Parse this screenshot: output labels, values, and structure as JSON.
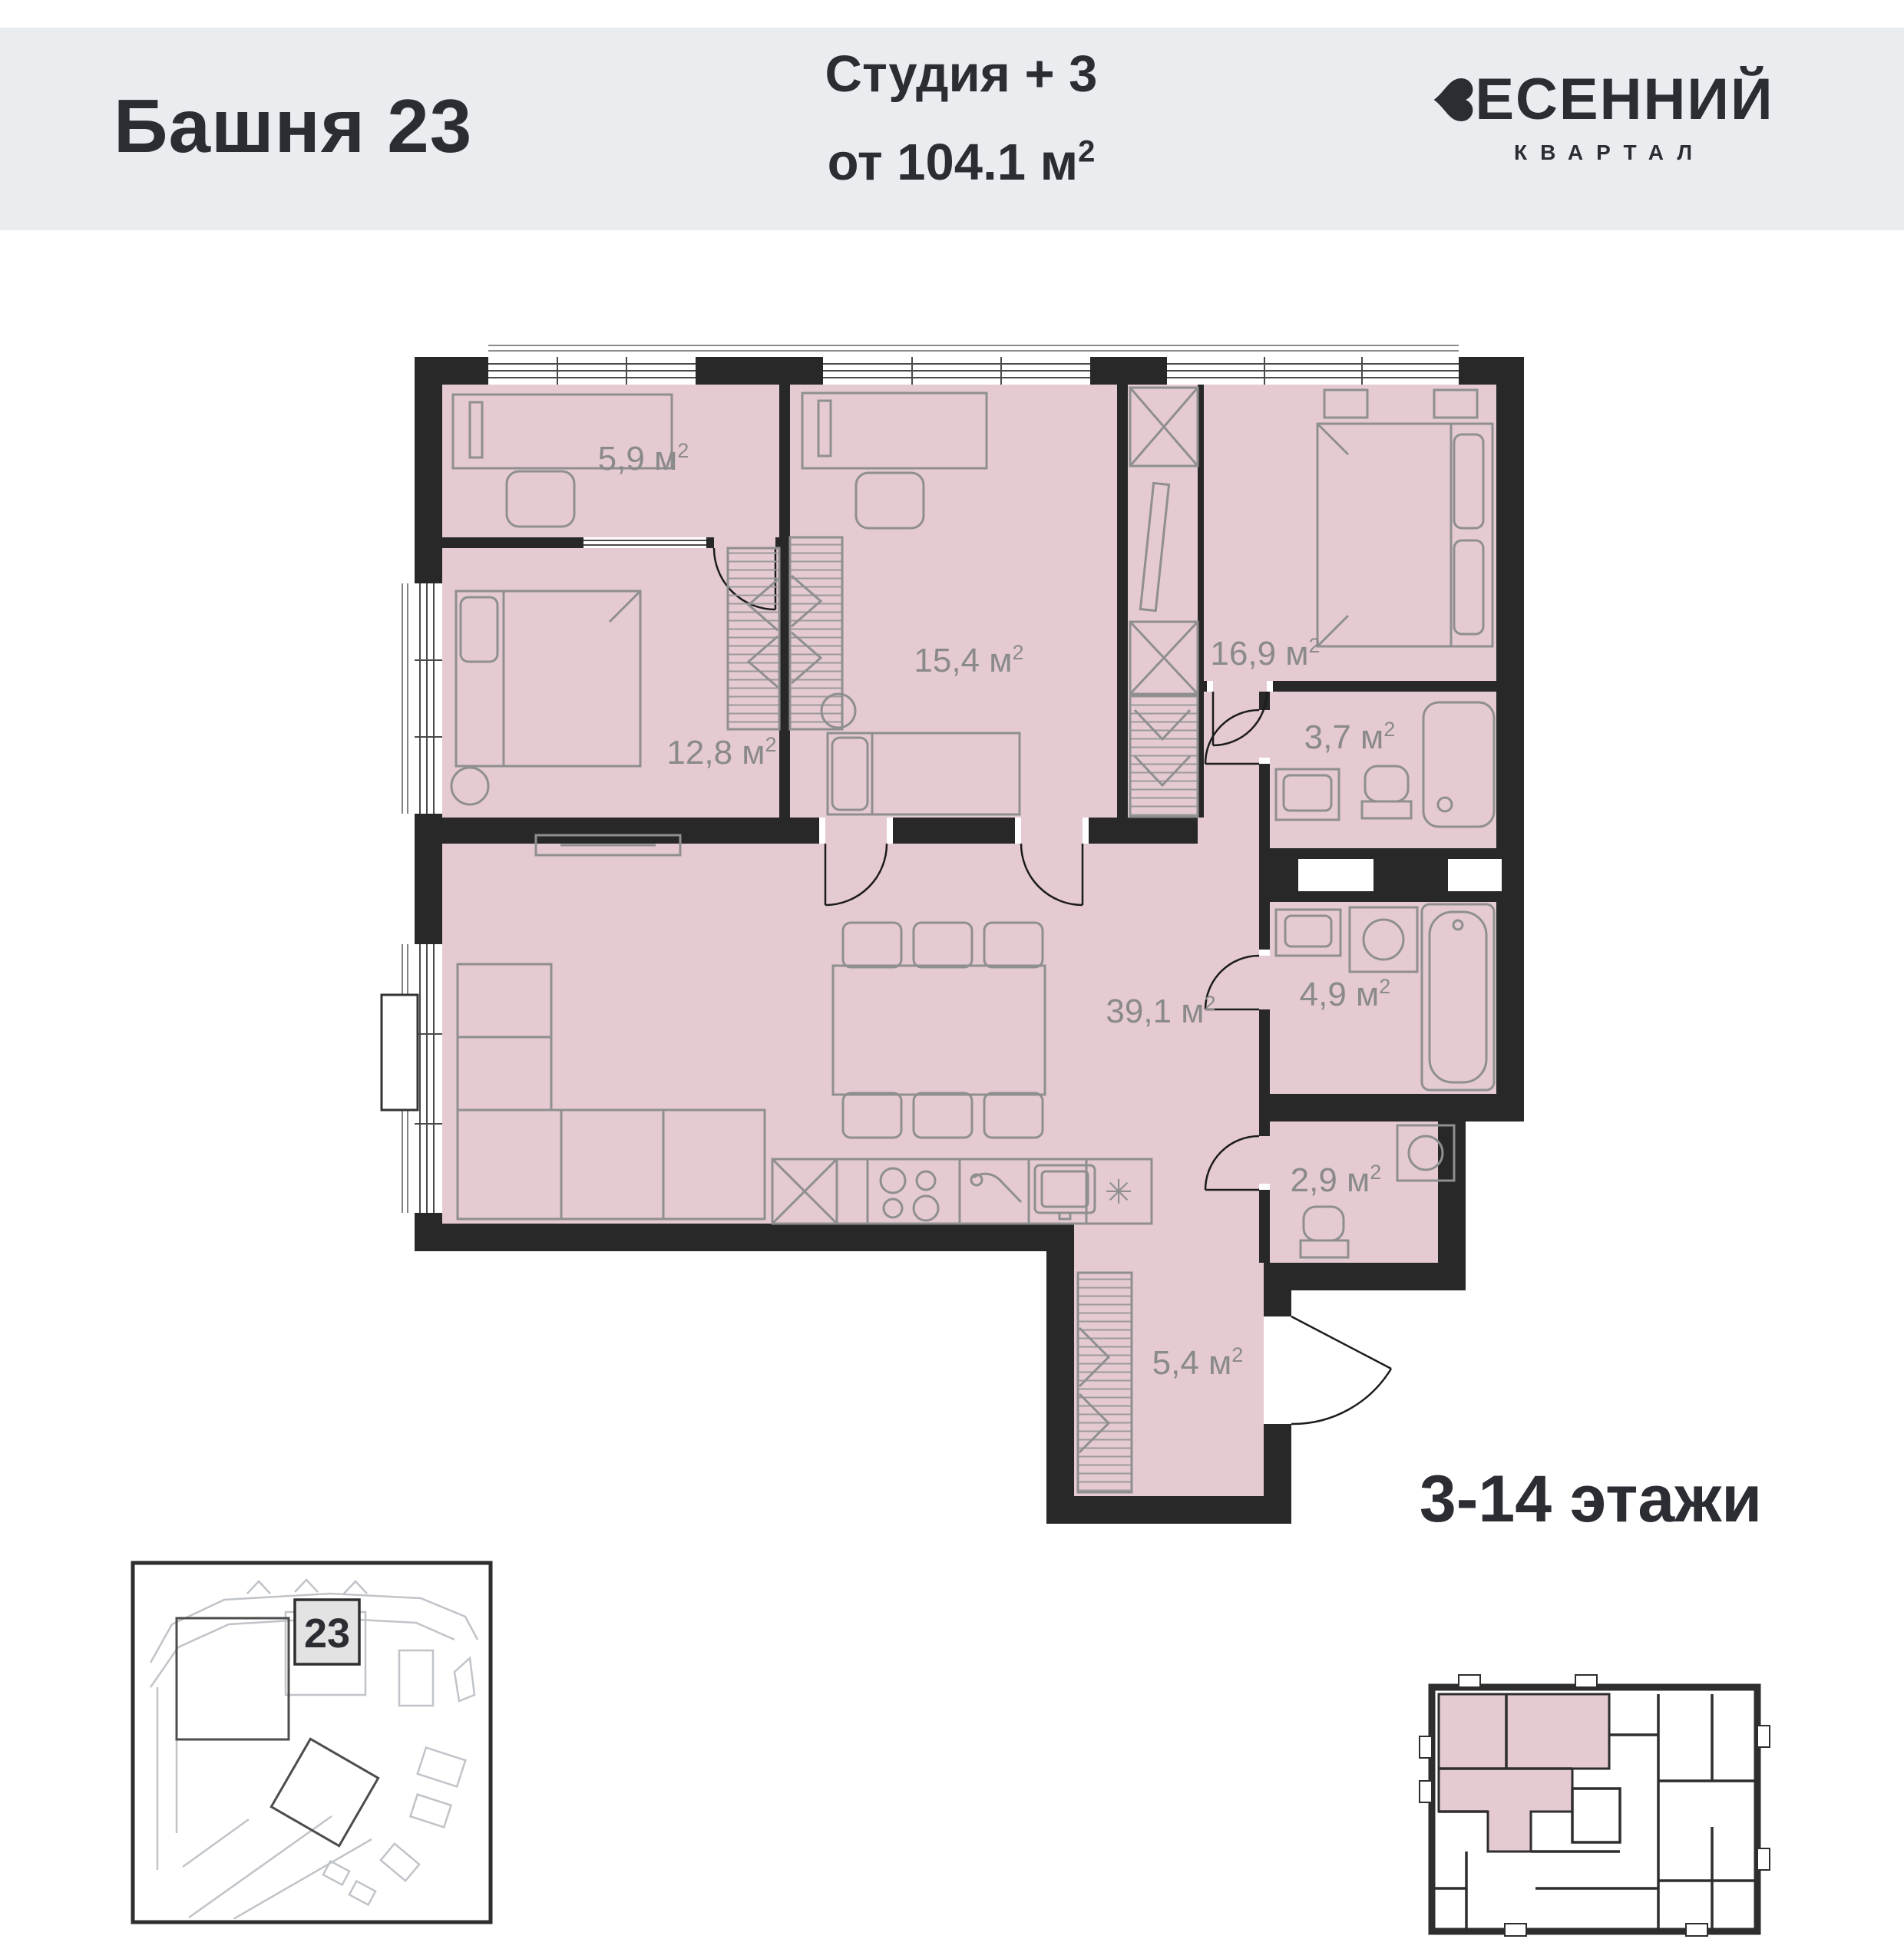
{
  "header": {
    "tower_title": "Башня 23",
    "unit_type": "Студия + 3",
    "area_prefix": "от 104.1 м",
    "area_sup": "2",
    "brand_name": "ВЕСЕННИЙ",
    "brand_name_rest": "ЕСЕННИЙ",
    "brand_subtitle": "КВАРТАЛ"
  },
  "plan": {
    "rooms": [
      {
        "name": "cabinet",
        "label": "5,9 м",
        "sup": "2"
      },
      {
        "name": "bedroom-2",
        "label": "15,4 м",
        "sup": "2"
      },
      {
        "name": "bedroom-master",
        "label": "16,9 м",
        "sup": "2"
      },
      {
        "name": "bedroom-1",
        "label": "12,8 м",
        "sup": "2"
      },
      {
        "name": "bathroom-small",
        "label": "3,7 м",
        "sup": "2"
      },
      {
        "name": "living-kitchen",
        "label": "39,1 м",
        "sup": "2"
      },
      {
        "name": "bathroom",
        "label": "4,9 м",
        "sup": "2"
      },
      {
        "name": "wc",
        "label": "2,9 м",
        "sup": "2"
      },
      {
        "name": "hallway",
        "label": "5,4 м",
        "sup": "2"
      }
    ],
    "fridge_symbol": "✳"
  },
  "floors": {
    "label": "3-14 этажи"
  },
  "site": {
    "building_number": "23"
  },
  "colors": {
    "header_bg": "#eaedf0",
    "text_dark": "#2b2d33",
    "wall": "#282828",
    "room_fill": "#e5cbd1",
    "furniture": "#8f8f8f",
    "area_label": "#8a8a8a"
  }
}
